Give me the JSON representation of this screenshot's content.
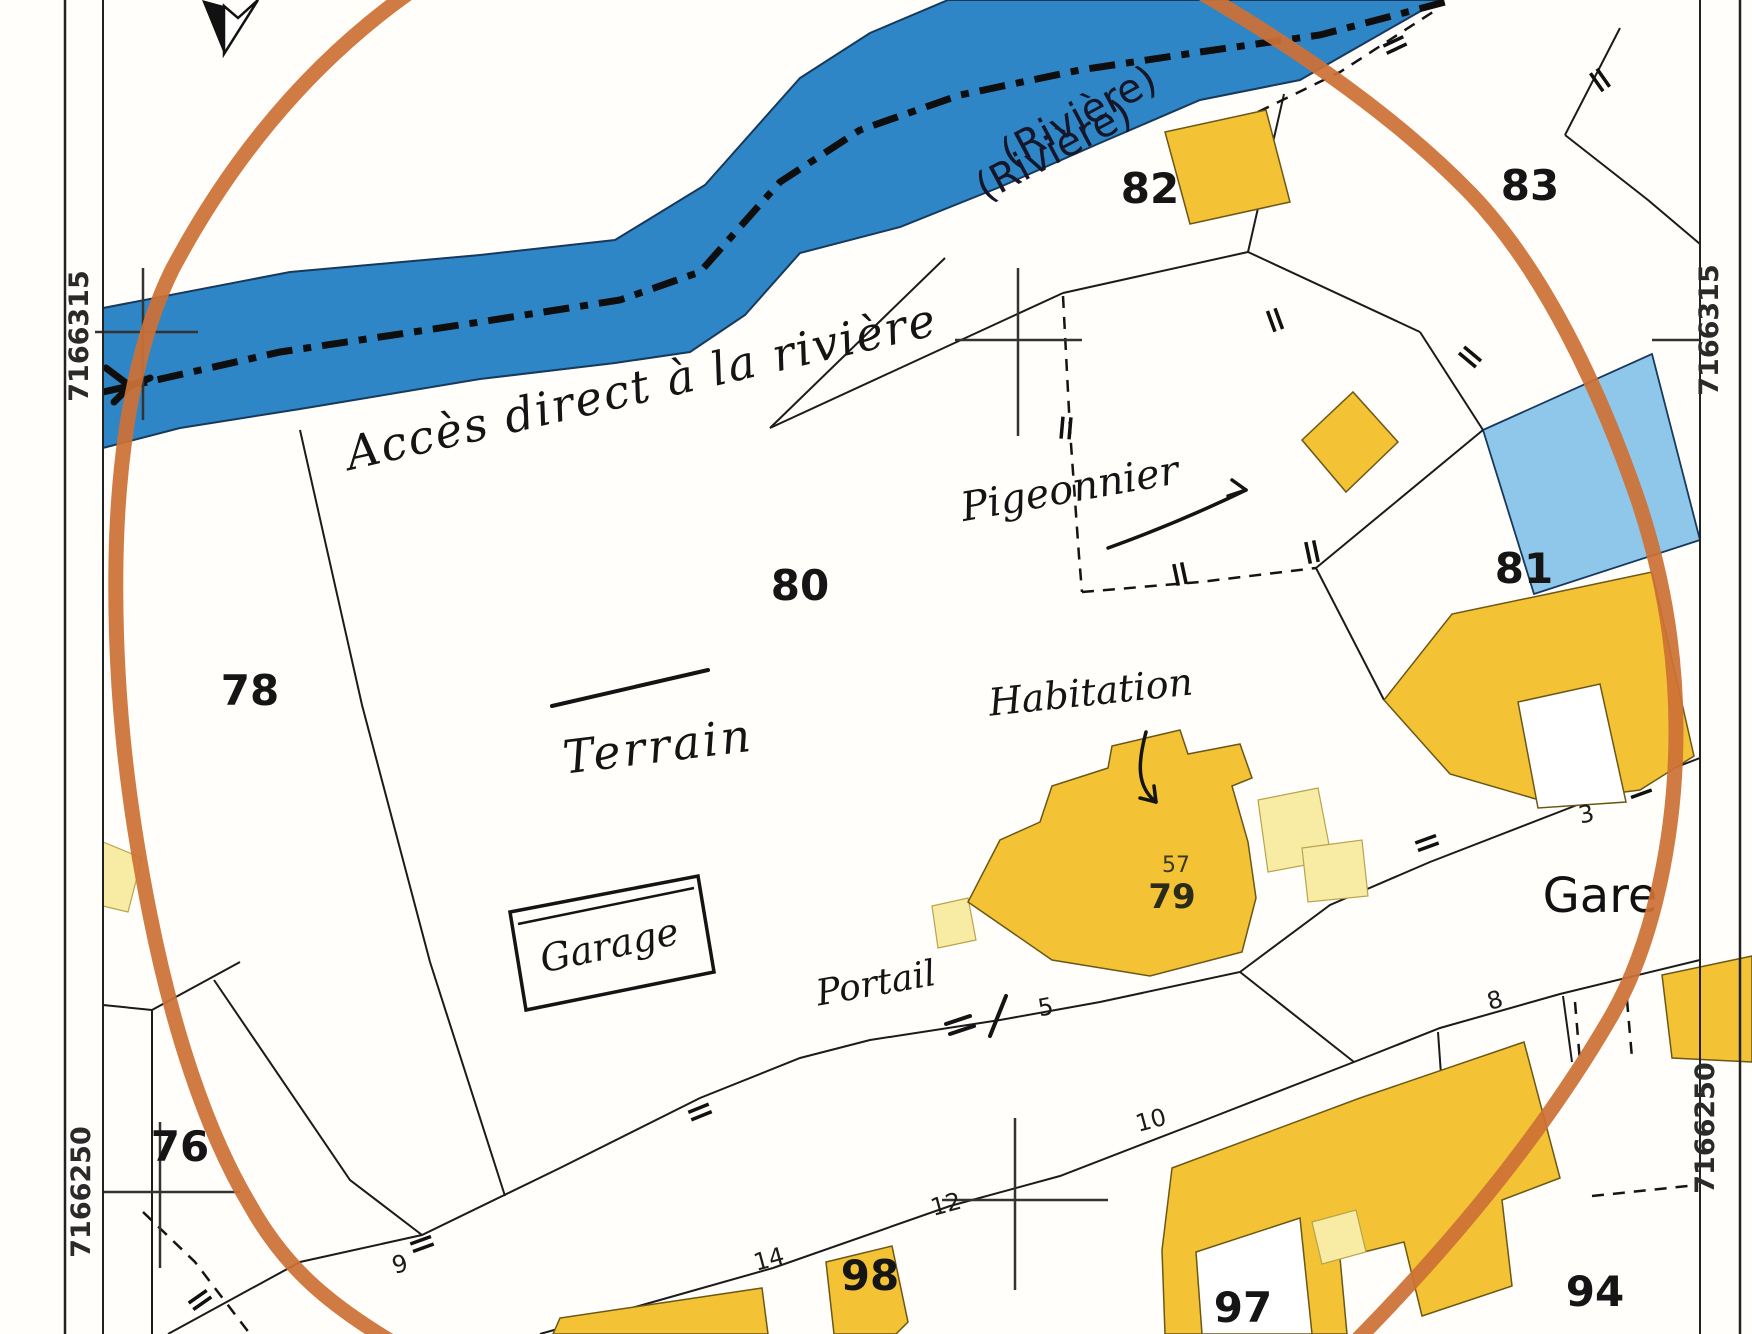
{
  "coordinates": {
    "top_left": "7166315",
    "top_right": "7166315",
    "bottom_left": "7166250",
    "bottom_right": "7166250"
  },
  "river": {
    "label_1": "(Rivière)",
    "label_2": "(Rivière)"
  },
  "handwritten": {
    "access": "Accès direct à la rivière",
    "pigeonnier": "Pigeonnier",
    "terrain": "Terrain",
    "habitation": "Habitation",
    "garage": "Garage",
    "portail": "Portail"
  },
  "parcels": {
    "p76": "76",
    "p78": "78",
    "p79": "79",
    "p80": "80",
    "p81": "81",
    "p82": "82",
    "p83": "83",
    "p94": "94",
    "p97": "97",
    "p98": "98"
  },
  "house_number": "57",
  "road_numbers": {
    "n3": "3",
    "n5": "5",
    "n8": "8",
    "n9": "9",
    "n10": "10",
    "n12": "12",
    "n14": "14"
  },
  "place": {
    "gare": "Gare"
  },
  "colors": {
    "river_blue": "#2F86C6",
    "pond_blue": "#8FC7EA",
    "building_yellow": "#F3C235",
    "building_pale": "#F8ECA4",
    "highlight_orange": "#CE7136",
    "line_black": "#1B1B1B"
  }
}
